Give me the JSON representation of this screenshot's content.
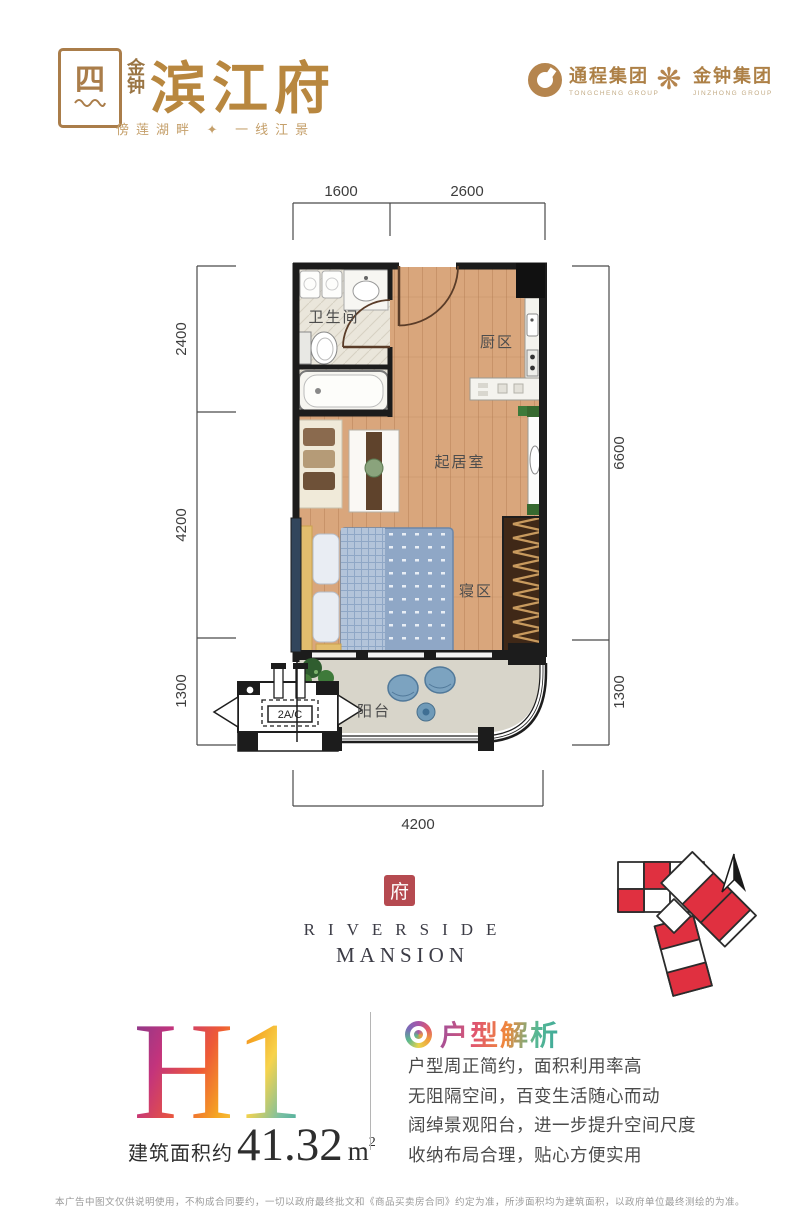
{
  "header": {
    "logo_seal_glyph": "四",
    "brand_vertical": "金钟",
    "brand_main": "滨江府",
    "tagline": "傍莲湖畔 ✦ 一线江景",
    "partner1": {
      "name": "通程集团",
      "sub": "TONGCHENG GROUP"
    },
    "partner2": {
      "name": "金钟集团",
      "sub": "JINZHONG GROUP"
    }
  },
  "floorplan": {
    "labels": {
      "bathroom": "卫生间",
      "kitchen": "厨区",
      "living": "起居室",
      "sleeping": "寝区",
      "balcony": "阳台",
      "ac": "2A/C"
    },
    "dims": {
      "top1": "1600",
      "top2": "2600",
      "left1": "2400",
      "left2": "4200",
      "left3": "1300",
      "right1": "6600",
      "right2": "1300",
      "bottom": "4200"
    }
  },
  "brandmark": {
    "seal": "府",
    "line1": "RIVERSIDE",
    "line2": "MANSION"
  },
  "unit": {
    "code": "H1",
    "area_label": "建筑面积约",
    "area_value": "41.32",
    "area_unit": "m",
    "area_sup": "2"
  },
  "analysis": {
    "title": "户型解析",
    "points": [
      "户型周正简约，面积利用率高",
      "无阻隔空间，百变生活随心而动",
      "阔绰景观阳台，进一步提升空间尺度",
      "收纳布局合理，贴心方便实用"
    ]
  },
  "disclaimer": "本广告中图文仅供说明使用，不构成合同要约，一切以政府最终批文和《商品买卖房合同》约定为准，所涉面积均为建筑面积，以政府单位最终测绘的为准。"
}
